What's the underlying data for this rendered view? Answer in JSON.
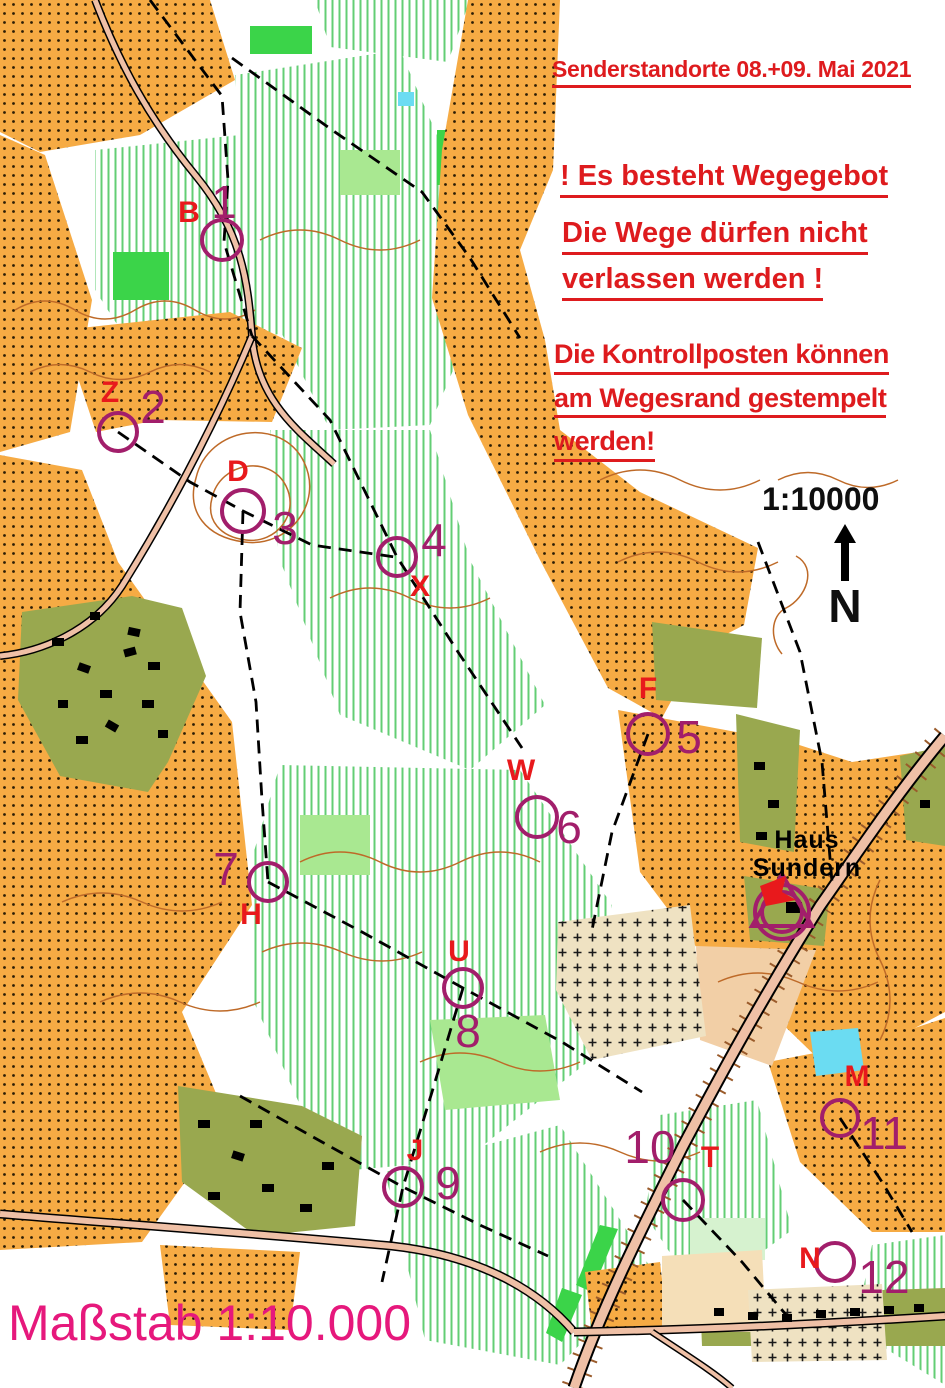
{
  "header": {
    "title": "Senderstandorte 08.+09. Mai 2021"
  },
  "notices": {
    "wegegebot": "! Es besteht Wegegebot",
    "wege_line1": "Die Wege dürfen nicht",
    "wege_line2": "verlassen werden !",
    "kontroll_line1": "Die Kontrollposten können",
    "kontroll_line2": "am Wegesrand gestempelt",
    "kontroll_line3": "werden!"
  },
  "scale": {
    "ratio": "1:10000",
    "north": "N"
  },
  "caption": {
    "text": "Maßstab 1:10.000"
  },
  "landmarks": {
    "haus_line1": "Haus",
    "haus_line2": "Sundern"
  },
  "controls": [
    {
      "number": "1",
      "letter": "B",
      "cx": 222,
      "cy": 240,
      "r": 22,
      "num": {
        "x": 224,
        "y": 202
      },
      "let": {
        "x": 189,
        "y": 213
      }
    },
    {
      "number": "2",
      "letter": "Z",
      "cx": 118,
      "cy": 432,
      "r": 21,
      "num": {
        "x": 153,
        "y": 407
      },
      "let": {
        "x": 110,
        "y": 393
      }
    },
    {
      "number": "3",
      "letter": "D",
      "cx": 243,
      "cy": 511,
      "r": 23,
      "num": {
        "x": 285,
        "y": 528
      },
      "let": {
        "x": 238,
        "y": 472
      }
    },
    {
      "number": "4",
      "letter": "X",
      "cx": 397,
      "cy": 557,
      "r": 21,
      "num": {
        "x": 434,
        "y": 540
      },
      "let": {
        "x": 420,
        "y": 587
      }
    },
    {
      "number": "5",
      "letter": "F",
      "cx": 648,
      "cy": 734,
      "r": 22,
      "num": {
        "x": 689,
        "y": 737
      },
      "let": {
        "x": 648,
        "y": 689
      }
    },
    {
      "number": "6",
      "letter": "W",
      "cx": 537,
      "cy": 817,
      "r": 22,
      "num": {
        "x": 569,
        "y": 827
      },
      "let": {
        "x": 521,
        "y": 771
      }
    },
    {
      "number": "7",
      "letter": "H",
      "cx": 268,
      "cy": 882,
      "r": 21,
      "num": {
        "x": 226,
        "y": 869
      },
      "let": {
        "x": 251,
        "y": 915
      }
    },
    {
      "number": "8",
      "letter": "U",
      "cx": 463,
      "cy": 988,
      "r": 21,
      "num": {
        "x": 468,
        "y": 1031
      },
      "let": {
        "x": 459,
        "y": 952
      }
    },
    {
      "number": "9",
      "letter": "J",
      "cx": 403,
      "cy": 1187,
      "r": 21,
      "num": {
        "x": 448,
        "y": 1183
      },
      "let": {
        "x": 415,
        "y": 1151
      }
    },
    {
      "number": "10",
      "letter": "T",
      "cx": 683,
      "cy": 1200,
      "r": 22,
      "num": {
        "x": 650,
        "y": 1147
      },
      "let": {
        "x": 710,
        "y": 1158
      }
    },
    {
      "number": "11",
      "letter": "M",
      "cx": 840,
      "cy": 1118,
      "r": 20,
      "num": {
        "x": 884,
        "y": 1133
      },
      "let": {
        "x": 857,
        "y": 1077
      }
    },
    {
      "number": "12",
      "letter": "N",
      "cx": 835,
      "cy": 1262,
      "r": 21,
      "num": {
        "x": 884,
        "y": 1277
      },
      "let": {
        "x": 810,
        "y": 1259
      }
    }
  ],
  "colors": {
    "control_purple": "#A21E6B",
    "label_red": "#E8191C",
    "notice_red": "#DE1B1E",
    "scale_magenta": "#E6187C",
    "rough_open_orange": "#F6AB44",
    "settlement_olive": "#99A84F",
    "forest_green": "#63CE74",
    "road_pink": "#EFC0A6",
    "contour_brown": "#BE6A28"
  }
}
